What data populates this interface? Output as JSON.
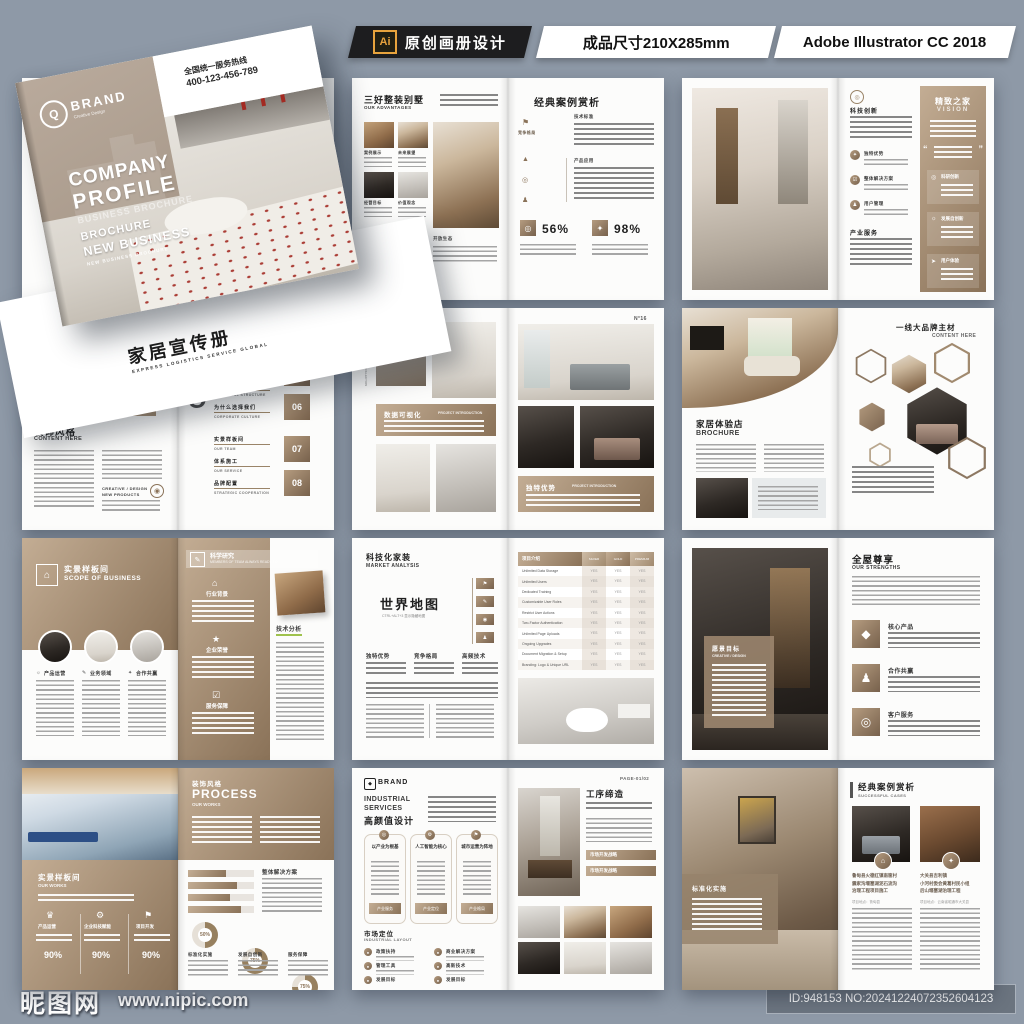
{
  "background": "#8e99a7",
  "header": {
    "ai_icon": "Ai",
    "design_badge": "原创画册设计",
    "size_badge": "成品尺寸210X285mm",
    "software_badge": "Adobe Illustrator CC 2018"
  },
  "icons": {
    "phone": "☎",
    "email": "✉",
    "globe": "◉",
    "flag": "⚑",
    "star": "✦",
    "check": "☑",
    "home": "⌂",
    "target": "◎",
    "diamond": "◆",
    "gear": "⚙",
    "crown": "♛",
    "pencil": "✎",
    "medal": "★",
    "dot": "●",
    "arrow": "➤",
    "sun": "☼",
    "chart": "▲",
    "pawn": "♟"
  },
  "mockup": {
    "brand_mark": "Q",
    "brand": "BRAND",
    "brand_sub": "Creative Design",
    "hotline_label": "全国统一服务热线",
    "hotline_number": "400-123-456-789",
    "title_line1": "COMPANY",
    "title_line2": "PROFILE",
    "ghost_text": "BUSINESS BROCHURE",
    "tag1": "BROCHURE",
    "tag2": "NEW BUSINESS",
    "tag3": "NEW BUSINESS BROCHURE",
    "back_title": "家居宣传册",
    "back_subtitle": "EXPRESS LOGISTICS SERVICE GLOBAL",
    "contact1": "Telephone",
    "contact2": "E-mail",
    "contact3": "Website"
  },
  "spreads": {
    "advantages": {
      "title": "三好整装别墅",
      "subtitle": "OUR ADVANTAGES",
      "thumbs": [
        "案例展示",
        "未来展望",
        "经营目标",
        "价值观念"
      ],
      "caption": "开放生态",
      "right_title": "经典案例赏析",
      "side_label": "竞争格局",
      "sec1": "技术标准",
      "sec2": "产品应用",
      "stat1": "56%",
      "stat2": "98%"
    },
    "vision": {
      "sec1": "科技创新",
      "items": [
        "独特优势",
        "整体解决方案",
        "用户管理"
      ],
      "sec2": "产业服务",
      "panel_title": "精致之家",
      "panel_sub": "VISION",
      "quote_open": "“",
      "quote_close": "”",
      "cards": [
        "科研创新",
        "发展自创新",
        "用户体验"
      ]
    },
    "contents": {
      "title": "装饰风格",
      "subtitle": "CONTENT HERE",
      "creative1": "CREATIVE / DESIGN",
      "creative2": "NEW PRODUCTS",
      "big_letters": "CO",
      "toc_en0": "REMARKS",
      "toc": [
        {
          "cn": "跨领设计体系",
          "en": "VISION"
        },
        {
          "cn": "我们的实力",
          "en": "INDUSTRIAL STRUCTURE"
        },
        {
          "cn": "为什么选择我们",
          "en": "CORPORATE CULTURE"
        },
        {
          "cn": "实景样板间",
          "en": "OUR TEAM"
        },
        {
          "cn": "体系施工",
          "en": "OUR SERVICE"
        },
        {
          "cn": "品牌配置",
          "en": "STRATEGIC COOPERATION"
        }
      ],
      "num1": "04",
      "num2": "05",
      "num3": "06",
      "num4": "07",
      "num5": "08"
    },
    "portfolio": {
      "side_cn": "毕业设计作品集",
      "side_en": "GRADUATION DESIGN WORKS COLLECTION",
      "banner1_cn": "数据可视化",
      "banner1_en": "PROJECT INTRODUCTION",
      "page_no": "N°16",
      "banner2_cn": "独特优势",
      "banner2_en": "PROJECT INTRODUCTION"
    },
    "hexagon": {
      "left_title": "家居体验店",
      "left_sub": "BROCHURE",
      "right_title": "一线大品牌主材",
      "right_sub": "CONTENT HERE"
    },
    "scope": {
      "title": "实景样板间",
      "subtitle": "SCOPE OF BUSINESS",
      "cols": [
        "产品运营",
        "业务领域",
        "合作共赢"
      ],
      "right_title": "科学研究",
      "right_sub": "MEMBERS OF TEAM ALWAYS READY TO",
      "items": [
        "行业背景",
        "企业荣誉",
        "服务保障"
      ],
      "analysis_label": "技术分析"
    },
    "market": {
      "title": "科技化家装",
      "subtitle": "MARKET ANALYSIS",
      "map_title": "世界地图",
      "map_hint": "CTRL+ALT+3 显示隐藏地图",
      "cols": [
        "独特优势",
        "竞争格局",
        "高频技术"
      ],
      "table_title": "项目介绍",
      "col_headers": [
        "SILVER",
        "GOLD",
        "PREMIUM"
      ],
      "yes": "YES",
      "rows": [
        "Unlimited Data Storage",
        "Unlimited Users",
        "Dedicated Training",
        "Customizable User Roles",
        "Restrict User Actions",
        "Two-Factor Authentication",
        "Unlimited Page Uploads",
        "Ongoing Upgrades",
        "Document Migration & Setup",
        "Branding: Logo & Unique URL"
      ]
    },
    "strengths": {
      "panel_title": "愿景目标",
      "panel_sub": "CREATIVE / DESIGN",
      "title": "全屋尊享",
      "subtitle": "OUR STRENGTHS",
      "items": [
        "核心产品",
        "合作共赢",
        "客户服务"
      ]
    },
    "works": {
      "title": "实景样板间",
      "subtitle": "OUR WORKS",
      "cols": [
        {
          "label": "产品运营",
          "pct": "90%"
        },
        {
          "label": "企业科技赋能",
          "pct": "90%"
        },
        {
          "label": "项目开发",
          "pct": "90%"
        }
      ],
      "right_title": "装饰风格",
      "right_big": "PROCESS",
      "right_sub": "OUR WORKS",
      "solution_label": "整体解决方案",
      "donuts": [
        {
          "label": "标准化实施",
          "pct": "50%"
        },
        {
          "label": "发展自创新",
          "pct": "75%"
        },
        {
          "label": "服务保障",
          "pct": "75%"
        }
      ]
    },
    "industrial": {
      "brand": "BRAND",
      "heading1": "INDUSTRIAL",
      "heading2": "SERVICES",
      "heading_cn": "高颜值设计",
      "cards": [
        {
          "title": "以产业为根基",
          "tab": "产业服务"
        },
        {
          "title": "人工智能为核心",
          "tab": "产业定位"
        },
        {
          "title": "城市运营为阵地",
          "tab": "产业格局"
        }
      ],
      "market_title": "市场定位",
      "market_sub": "INDUSTRIAL LAYOUT",
      "items": [
        "政策扶持",
        "管理工具",
        "发展目标",
        "商业解决方案",
        "高新技术",
        "发展目标"
      ],
      "page_label": "PAGE-01/02",
      "right_title": "工序缔造",
      "bar1": "市场开发战略",
      "bar2": "市场开发战略"
    },
    "cases": {
      "panel_title": "标准化实施",
      "title": "经典案例赏析",
      "subtitle": "SUCCESSFUL CASES",
      "case1": [
        "鲁甸县火德红镇南筐村",
        "震家沟堰塞湖泥石流沟",
        "治理工程项目施工"
      ],
      "case1_loc": "项目地点：鲁甸县",
      "case2": [
        "大关县吉利镇",
        "小河村委会黄葛村民小组",
        "后山堰塞湖治理工程"
      ],
      "case2_loc": "项目地点：云南省昭通市大关县"
    }
  },
  "watermark": {
    "site_name": "昵图网",
    "site_url": "www.nipic.com",
    "id_text": "ID:948153 NO:20241224072352604123"
  }
}
